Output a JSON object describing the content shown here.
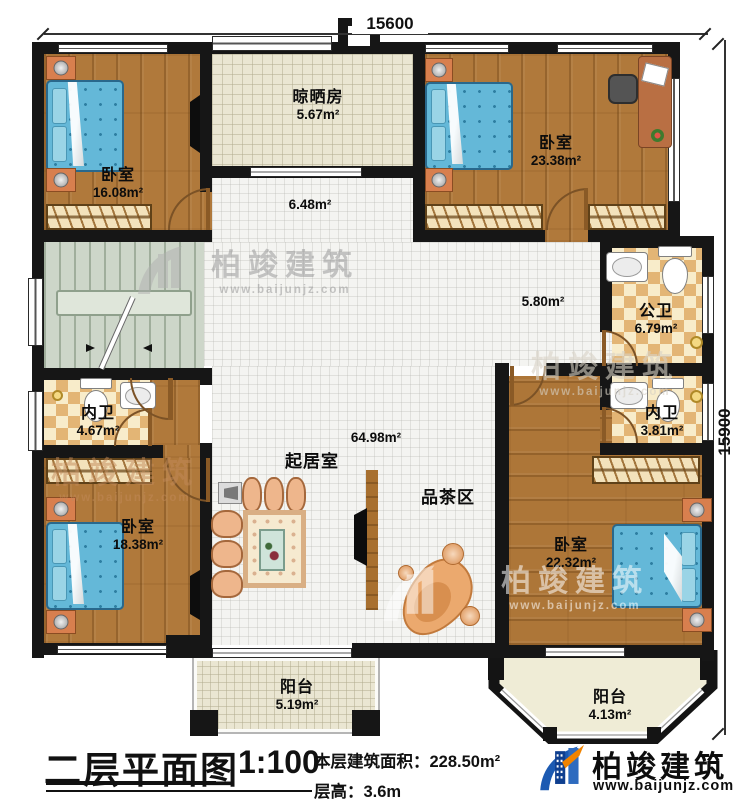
{
  "dimensions": {
    "top": "15600",
    "right": "15900"
  },
  "rooms": {
    "bedroom_tl": {
      "name": "卧室",
      "area": "16.08m²"
    },
    "drying_room": {
      "name": "晾晒房",
      "area": "5.67m²"
    },
    "bedroom_tr": {
      "name": "卧室",
      "area": "23.38m²"
    },
    "hall_upper": {
      "area": "6.48m²"
    },
    "hall_mid": {
      "area": "5.80m²"
    },
    "living": {
      "name": "起居室",
      "area": "64.98m²"
    },
    "tea_area": {
      "name": "品茶区"
    },
    "public_bath": {
      "name": "公卫",
      "area": "6.79m²"
    },
    "ensuite_bath_right": {
      "name": "内卫",
      "area": "3.81m²"
    },
    "ensuite_bath_left": {
      "name": "内卫",
      "area": "4.67m²"
    },
    "bedroom_bl": {
      "name": "卧室",
      "area": "18.38m²"
    },
    "bedroom_br": {
      "name": "卧室",
      "area": "22.32m²"
    },
    "balcony_mid": {
      "name": "阳台",
      "area": "5.19m²"
    },
    "balcony_br": {
      "name": "阳台",
      "area": "4.13m²"
    }
  },
  "titleblock": {
    "title": "二层平面图",
    "scale": "1:100",
    "area_line": "本层建筑面积：228.50m²",
    "height_line": "层高：3.6m"
  },
  "branding": {
    "name": "柏竣建筑",
    "url": "www.baijunjz.com",
    "watermark_name": "柏竣建筑",
    "watermark_url": "www.baijunjz.com"
  },
  "colors": {
    "wall": "#161616",
    "wood": "#b0793b",
    "bed_blue": "#64b8d8",
    "checker": "#e3b575",
    "stairs": "#cdd6c9",
    "logo_blue": "#1c4f9c",
    "logo_orange": "#f08300"
  }
}
